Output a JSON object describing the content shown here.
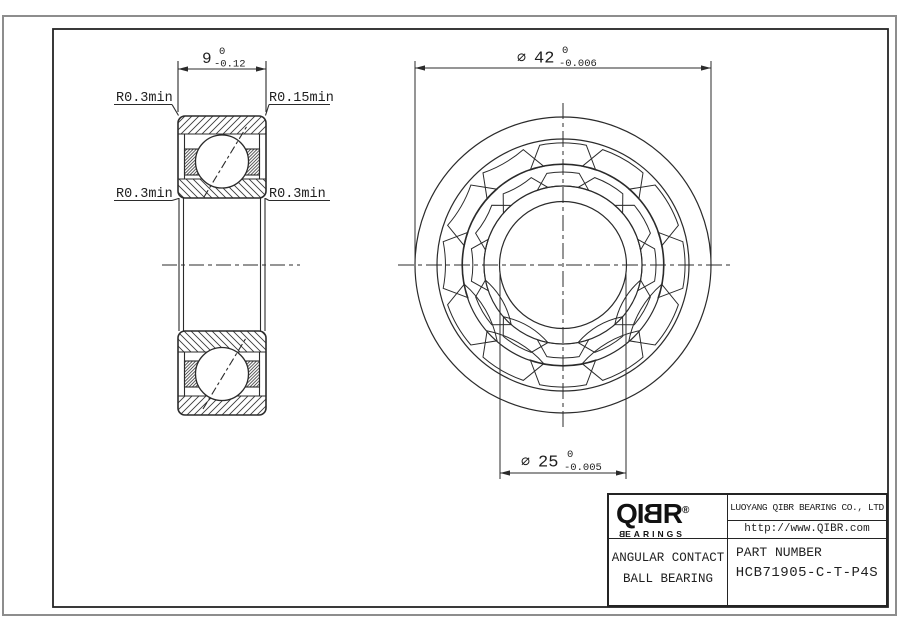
{
  "drawing": {
    "section_view": {
      "width_dim": {
        "value": "9",
        "tol_top": "0",
        "tol_bottom": "-0.12"
      },
      "labels": {
        "top_left": "R0.3min",
        "top_right": "R0.15min",
        "mid_left": "R0.3min",
        "mid_right": "R0.3min"
      }
    },
    "front_view": {
      "od_dim": {
        "phi": "∅",
        "value": "42",
        "tol_top": "0",
        "tol_bottom": "-0.006"
      },
      "bore_dim": {
        "phi": "∅",
        "value": "25",
        "tol_top": "0",
        "tol_bottom": "-0.005"
      }
    }
  },
  "title_block": {
    "logo": {
      "pre": "QI",
      "mirrored_b": "B",
      "post": "R",
      "registered": "®",
      "sub_mirrored_b": "B",
      "sub_rest": "EARINGS"
    },
    "company": "LUOYANG QIBR BEARING CO., LTD",
    "website": "http://www.QIBR.com",
    "product_line1": "ANGULAR CONTACT",
    "product_line2": "BALL BEARING",
    "part_number_label": "PART NUMBER",
    "part_number": "HCB71905-C-T-P4S"
  },
  "colors": {
    "line": "#2b2b2b",
    "hatch": "#3a3a3a",
    "page_border": "#8d8d8d"
  }
}
